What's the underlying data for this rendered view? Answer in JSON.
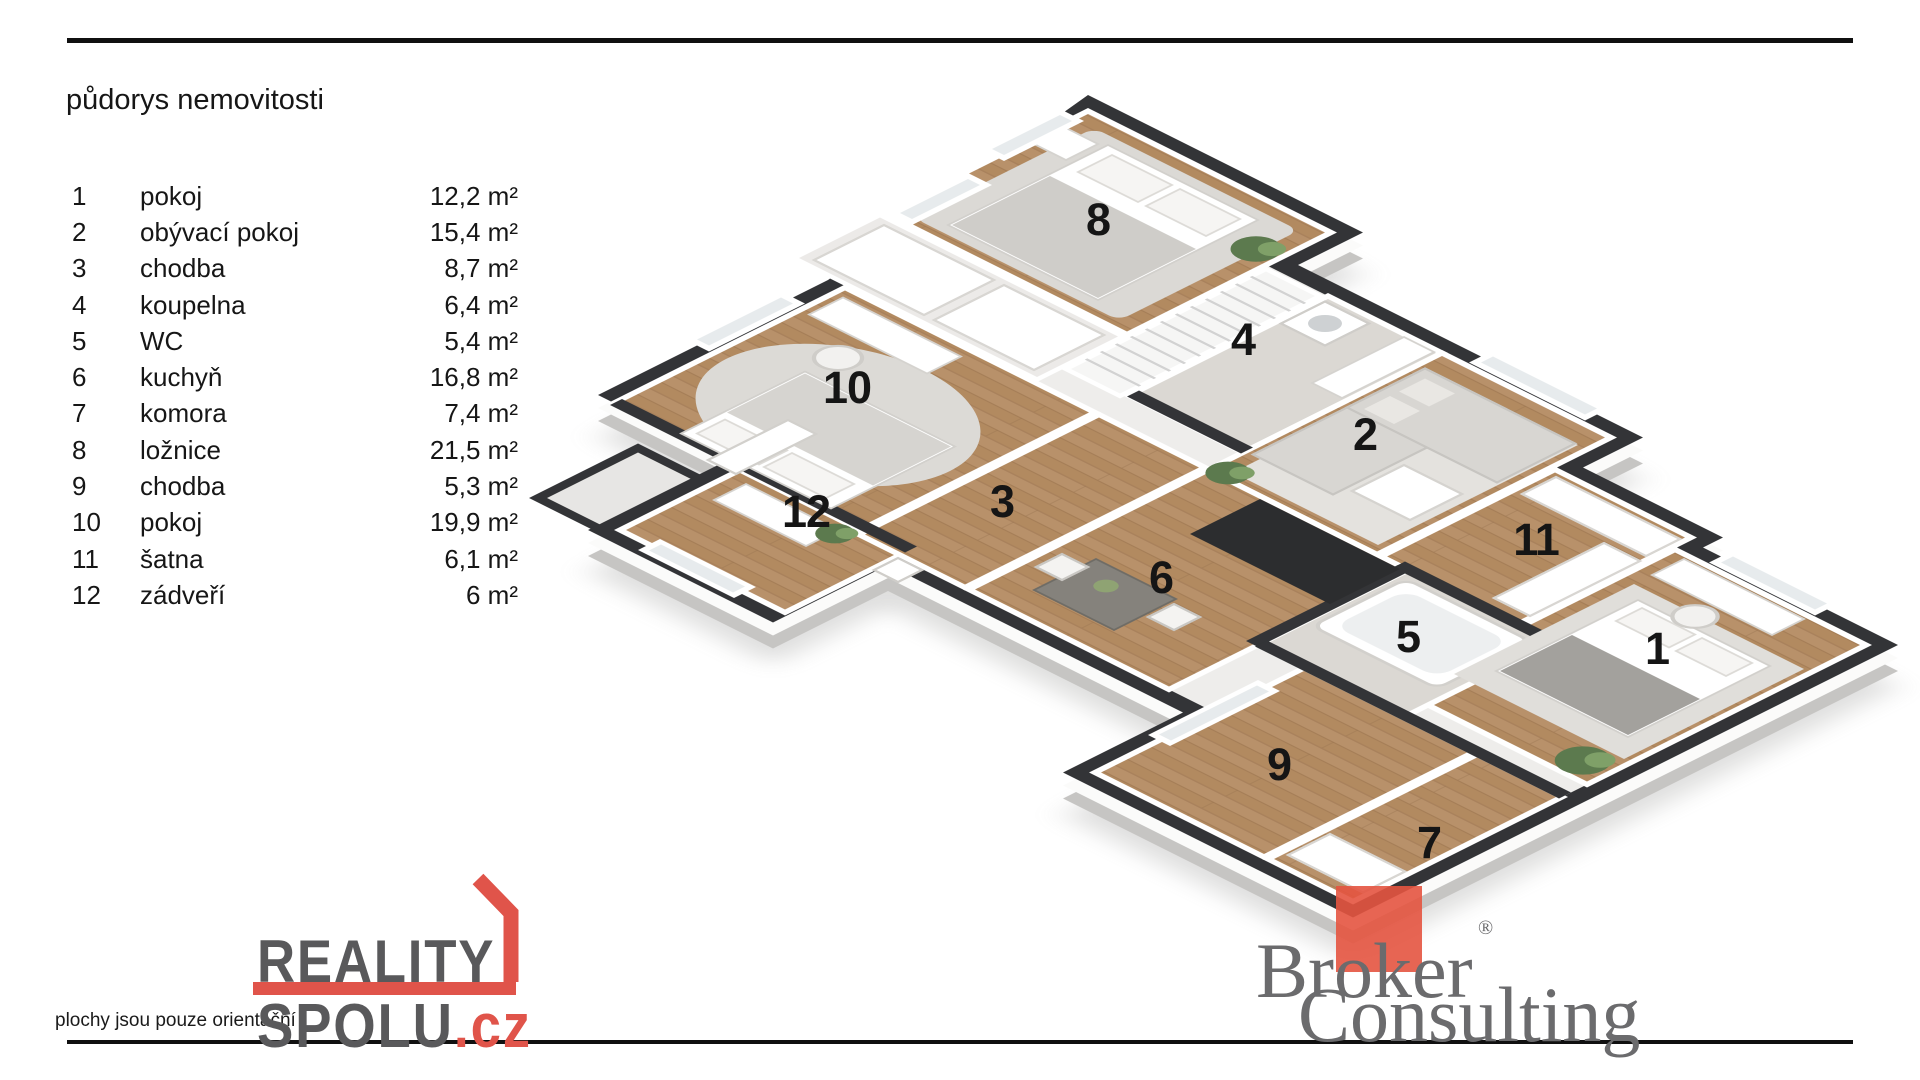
{
  "header": {
    "title": "půdorys nemovitosti"
  },
  "legend": {
    "rooms": [
      {
        "num": "1",
        "name": "pokoj",
        "area": "12,2 m²"
      },
      {
        "num": "2",
        "name": "obývací pokoj",
        "area": "15,4 m²"
      },
      {
        "num": "3",
        "name": "chodba",
        "area": "8,7 m²"
      },
      {
        "num": "4",
        "name": "koupelna",
        "area": "6,4 m²"
      },
      {
        "num": "5",
        "name": "WC",
        "area": "5,4 m²"
      },
      {
        "num": "6",
        "name": "kuchyň",
        "area": "16,8 m²"
      },
      {
        "num": "7",
        "name": "komora",
        "area": "7,4 m²"
      },
      {
        "num": "8",
        "name": "ložnice",
        "area": "21,5 m²"
      },
      {
        "num": "9",
        "name": "chodba",
        "area": "5,3 m²"
      },
      {
        "num": "10",
        "name": "pokoj",
        "area": "19,9 m²"
      },
      {
        "num": "11",
        "name": "šatna",
        "area": "6,1 m²"
      },
      {
        "num": "12",
        "name": "zádveří",
        "area": "6 m²"
      }
    ]
  },
  "plan": {
    "labels": [
      "1",
      "2",
      "3",
      "4",
      "5",
      "6",
      "7",
      "8",
      "9",
      "10",
      "11",
      "12"
    ]
  },
  "footer": {
    "disclaimer": "plochy jsou pouze orientační",
    "brand_left": {
      "line1": "REALITY",
      "line2": "SPOLU",
      "tld": ".cz"
    },
    "brand_right": {
      "word1": "Broker",
      "word2": "Consulting",
      "reg": "®"
    }
  },
  "colors": {
    "text": "#1b1b1b",
    "brand-gray": "#59595b",
    "logo-red": "#e0544a",
    "broker-gray": "#6b6b6d",
    "broker-red": "#e45440",
    "wall-dark": "#333437",
    "wood": "#b28a60",
    "tile": "#dbd8d3",
    "rug": "#dedcd8"
  }
}
